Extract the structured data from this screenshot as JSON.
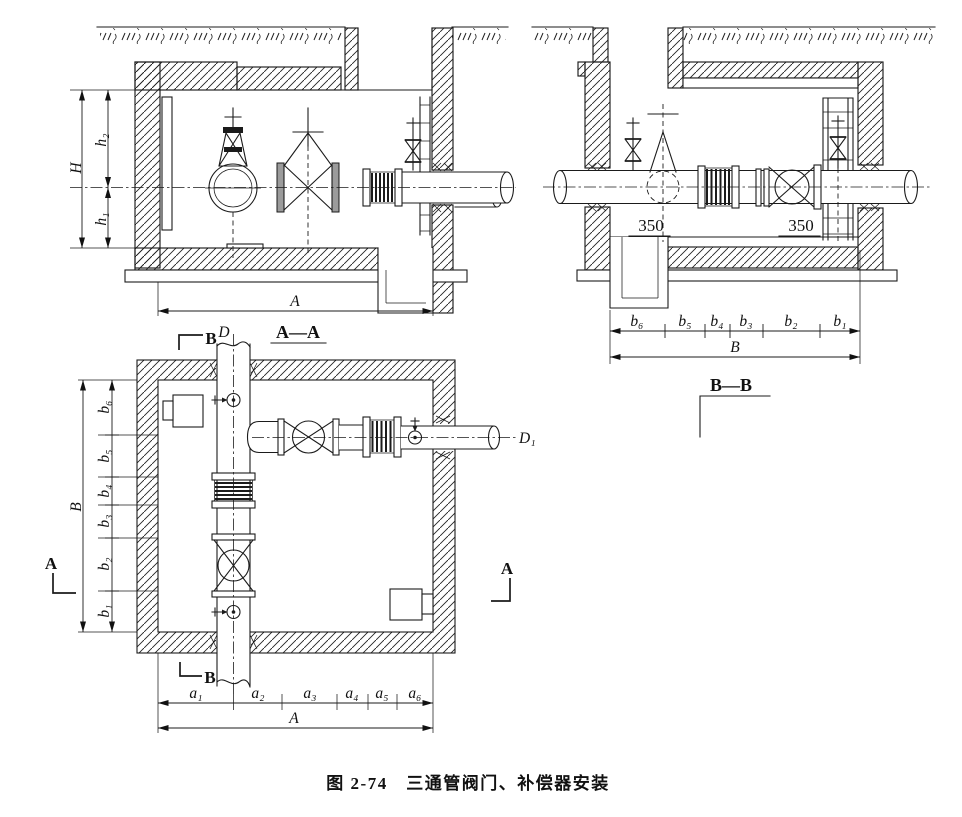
{
  "figure": {
    "caption": "图 2-74　三通管阀门、补偿器安装"
  },
  "section_AA": {
    "title": "A—A",
    "dim_H": "H",
    "dim_h2": "h₂",
    "dim_h1": "h₁",
    "dim_A": "A"
  },
  "section_BB": {
    "title": "B—B",
    "offset_left": "350",
    "offset_right": "350",
    "dim_b": [
      "b₆",
      "b₅",
      "b₄",
      "b₃",
      "b₂",
      "b₁"
    ],
    "dim_B": "B"
  },
  "plan": {
    "marker_B_top": "B",
    "marker_B_bottom": "B",
    "marker_A_left": "A",
    "marker_A_right": "A",
    "pipe_label_D": "D",
    "pipe_label_D1": "D₁",
    "dim_b": [
      "b₆",
      "b₅",
      "b₄",
      "b₃",
      "b₂",
      "b₁"
    ],
    "dim_B": "B",
    "dim_a": [
      "a₁",
      "a₂",
      "a₃",
      "a₄",
      "a₅",
      "a₆"
    ],
    "dim_A": "A"
  }
}
